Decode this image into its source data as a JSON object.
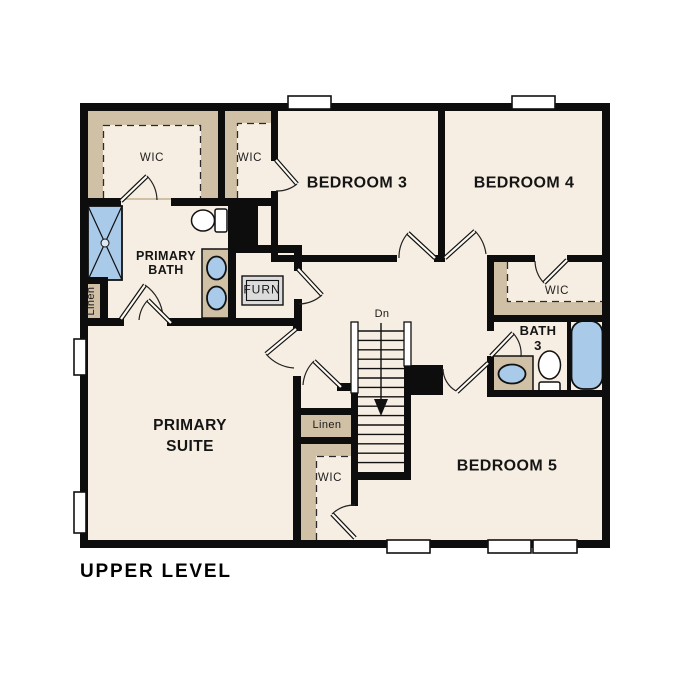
{
  "title": "UPPER LEVEL",
  "colors": {
    "floor": "#f6eee2",
    "wall": "#0d0d0d",
    "closet_tan": "#cfc0a6",
    "fixture_blue": "#a9cae9",
    "furnace_gray": "#dcdcdc",
    "text": "#151515",
    "background": "#ffffff"
  },
  "rooms": {
    "primary_wic": "WIC",
    "bedroom3_wic": "WIC",
    "bedroom3": "BEDROOM 3",
    "bedroom4": "BEDROOM 4",
    "primary_bath": [
      "PRIMARY",
      "BATH"
    ],
    "furnace": "FURN",
    "linen_bath": "Linen",
    "bedroom4_wic": "WIC",
    "bath3": [
      "BATH",
      "3"
    ],
    "primary_suite": [
      "PRIMARY",
      "SUITE"
    ],
    "stairs_direction": "Dn",
    "linen_hall": "Linen",
    "bedroom5_wic": "WIC",
    "bedroom5": "BEDROOM 5"
  }
}
